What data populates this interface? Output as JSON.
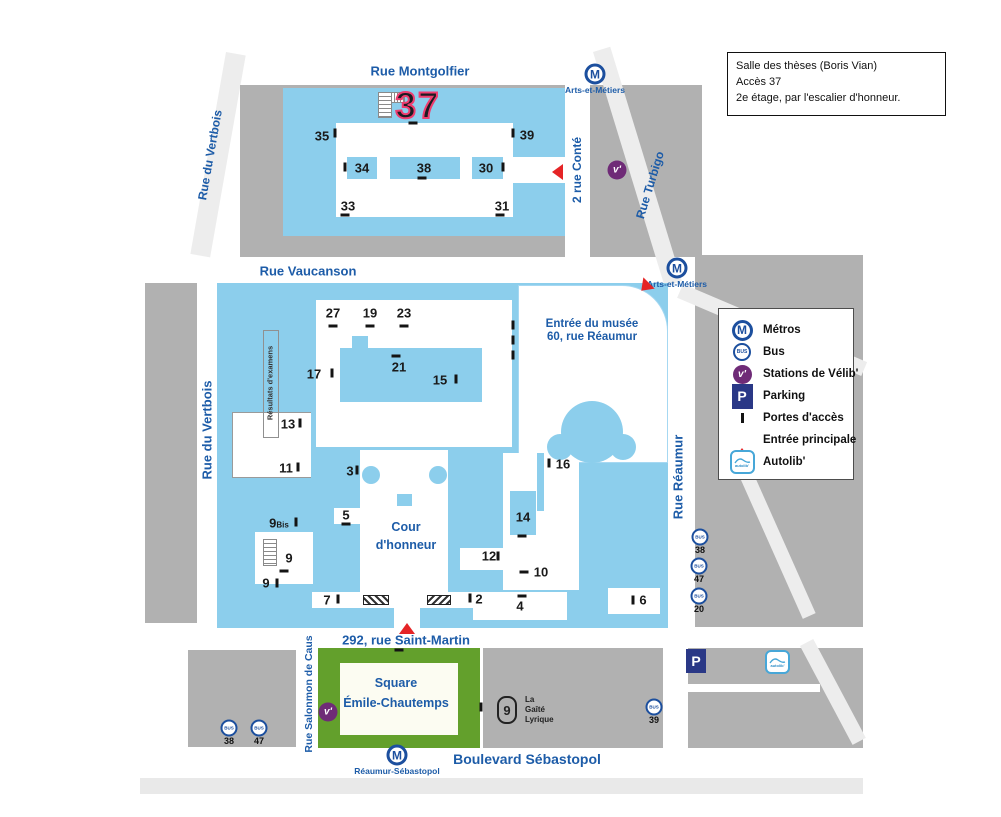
{
  "info_box": {
    "lines": [
      "Salle des thèses (Boris Vian)",
      "Accès 37",
      "2e étage, par l'escalier d'honneur."
    ]
  },
  "legend": {
    "items": [
      {
        "icon": "metro-icon",
        "label": "Métros"
      },
      {
        "icon": "bus-icon",
        "label": "Bus"
      },
      {
        "icon": "velib-icon",
        "label": "Stations de Vélib'"
      },
      {
        "icon": "parking-icon",
        "label": "Parking"
      },
      {
        "icon": "gate-icon",
        "label": "Portes  d'accès"
      },
      {
        "icon": "entrance-arrow-icon",
        "label": "Entrée  principale"
      },
      {
        "icon": "autolib-icon",
        "label": "Autolib'"
      }
    ]
  },
  "places": {
    "cour": [
      "Cour",
      "d'honneur"
    ],
    "musee": [
      "Entrée du musée",
      "60, rue Réaumur"
    ],
    "square": [
      "Square",
      "Émile-Chautemps"
    ],
    "gaite": [
      "La",
      "Gaîté",
      "Lyrique"
    ],
    "gaite_glyph": "9",
    "resultats": "Résultats d'examens"
  },
  "colors": {
    "building_blue": "#8CCEEC",
    "block_gray": "#B1B1B1",
    "street_gray": "#EDEDED",
    "text_blue": "#1D5CA8",
    "metro_blue": "#1C4F9E",
    "velib_purple": "#6F2B77",
    "parking_navy": "#2A3886",
    "arrow_red": "#E52426",
    "square_green": "#63A02C",
    "big_number_outline_pink": "#EE3D6F"
  },
  "map": {
    "streets": [
      {
        "label": "Rue Montgolfier",
        "x": 420,
        "y": 71,
        "size": 13
      },
      {
        "label": "Rue du Vertbois",
        "x": 210,
        "y": 155,
        "rot": -80,
        "size": 12
      },
      {
        "label": "2 rue Conté",
        "x": 577,
        "y": 170,
        "rot": -90,
        "size": 12
      },
      {
        "label": "Rue Turbigo",
        "x": 650,
        "y": 185,
        "rot": -73,
        "size": 12
      },
      {
        "label": "Rue Vaucanson",
        "x": 308,
        "y": 271,
        "size": 13
      },
      {
        "label": "Rue du Vertbois",
        "x": 207,
        "y": 430,
        "rot": -90,
        "size": 13
      },
      {
        "label": "Rue Réaumur",
        "x": 678,
        "y": 477,
        "rot": -90,
        "size": 13
      },
      {
        "label": "292, rue Saint-Martin",
        "x": 406,
        "y": 640,
        "size": 13
      },
      {
        "label": "Rue Salonmon de Caus",
        "x": 309,
        "y": 694,
        "rot": -90,
        "size": 10.5
      },
      {
        "label": "Boulevard Sébastopol",
        "x": 527,
        "y": 759,
        "size": 14
      }
    ],
    "metros": [
      {
        "label": "Arts-et-Métiers",
        "cx": 595,
        "cy": 74,
        "lx": 595,
        "ly": 90
      },
      {
        "label": "Arts-et-Métiers",
        "cx": 677,
        "cy": 268,
        "lx": 677,
        "ly": 284
      },
      {
        "label": "Réaumur-Sébastopol",
        "cx": 397,
        "cy": 755,
        "lx": 397,
        "ly": 771
      }
    ],
    "velib": [
      {
        "x": 617,
        "y": 170
      },
      {
        "x": 328,
        "y": 712
      }
    ],
    "bus_stops": [
      {
        "n": "38",
        "x": 700,
        "y": 537
      },
      {
        "n": "47",
        "x": 699,
        "y": 566
      },
      {
        "n": "20",
        "x": 699,
        "y": 596
      },
      {
        "n": "38",
        "x": 229,
        "y": 728
      },
      {
        "n": "47",
        "x": 259,
        "y": 728
      },
      {
        "n": "39",
        "x": 654,
        "y": 707
      }
    ],
    "parking": [
      {
        "x": 686,
        "y": 649
      }
    ],
    "autolib": [
      {
        "x": 765,
        "y": 650
      }
    ],
    "arrows": [
      {
        "x": 538,
        "y": 161,
        "rot": -90
      },
      {
        "x": 629,
        "y": 284,
        "rot": -135
      },
      {
        "x": 399,
        "y": 606,
        "rot": 0
      }
    ],
    "numbers": [
      {
        "l": "37",
        "x": 418,
        "y": 106,
        "big": 1
      },
      {
        "l": "35",
        "x": 322,
        "y": 136
      },
      {
        "l": "39",
        "x": 527,
        "y": 135
      },
      {
        "l": "34",
        "x": 362,
        "y": 168
      },
      {
        "l": "38",
        "x": 424,
        "y": 168
      },
      {
        "l": "30",
        "x": 486,
        "y": 168
      },
      {
        "l": "33",
        "x": 348,
        "y": 206
      },
      {
        "l": "31",
        "x": 502,
        "y": 206
      },
      {
        "l": "27",
        "x": 333,
        "y": 313
      },
      {
        "l": "19",
        "x": 370,
        "y": 313
      },
      {
        "l": "23",
        "x": 404,
        "y": 313
      },
      {
        "l": "17",
        "x": 314,
        "y": 374
      },
      {
        "l": "21",
        "x": 399,
        "y": 367
      },
      {
        "l": "15",
        "x": 440,
        "y": 380
      },
      {
        "l": "13",
        "x": 288,
        "y": 424
      },
      {
        "l": "11",
        "x": 286,
        "y": 468
      },
      {
        "l": "9",
        "sub": "Bis",
        "x": 279,
        "y": 523
      },
      {
        "l": "9",
        "x": 289,
        "y": 558
      },
      {
        "l": "9",
        "x": 266,
        "y": 583
      },
      {
        "l": "3",
        "x": 350,
        "y": 471
      },
      {
        "l": "5",
        "x": 346,
        "y": 515
      },
      {
        "l": "16",
        "x": 563,
        "y": 464
      },
      {
        "l": "14",
        "x": 523,
        "y": 517
      },
      {
        "l": "12",
        "x": 489,
        "y": 556
      },
      {
        "l": "10",
        "x": 541,
        "y": 572
      },
      {
        "l": "7",
        "x": 327,
        "y": 600
      },
      {
        "l": "2",
        "x": 479,
        "y": 599
      },
      {
        "l": "4",
        "x": 520,
        "y": 606
      },
      {
        "l": "6",
        "x": 643,
        "y": 600
      }
    ],
    "ticks": [
      {
        "x": 335,
        "y": 133,
        "o": "v"
      },
      {
        "x": 513,
        "y": 133,
        "o": "v"
      },
      {
        "x": 413,
        "y": 123,
        "o": "h"
      },
      {
        "x": 345,
        "y": 167,
        "o": "v"
      },
      {
        "x": 422,
        "y": 178,
        "o": "h"
      },
      {
        "x": 503,
        "y": 167,
        "o": "v"
      },
      {
        "x": 345,
        "y": 215,
        "o": "h"
      },
      {
        "x": 500,
        "y": 215,
        "o": "h"
      },
      {
        "x": 333,
        "y": 326,
        "o": "h"
      },
      {
        "x": 370,
        "y": 326,
        "o": "h"
      },
      {
        "x": 404,
        "y": 326,
        "o": "h"
      },
      {
        "x": 396,
        "y": 356,
        "o": "h"
      },
      {
        "x": 332,
        "y": 373,
        "o": "v"
      },
      {
        "x": 456,
        "y": 379,
        "o": "v"
      },
      {
        "x": 300,
        "y": 423,
        "o": "v"
      },
      {
        "x": 298,
        "y": 467,
        "o": "v"
      },
      {
        "x": 296,
        "y": 522,
        "o": "v"
      },
      {
        "x": 284,
        "y": 571,
        "o": "h"
      },
      {
        "x": 277,
        "y": 583,
        "o": "v"
      },
      {
        "x": 357,
        "y": 470,
        "o": "v"
      },
      {
        "x": 346,
        "y": 524,
        "o": "h"
      },
      {
        "x": 338,
        "y": 599,
        "o": "v"
      },
      {
        "x": 470,
        "y": 598,
        "o": "v"
      },
      {
        "x": 522,
        "y": 596,
        "o": "h"
      },
      {
        "x": 524,
        "y": 572,
        "o": "h"
      },
      {
        "x": 522,
        "y": 536,
        "o": "h"
      },
      {
        "x": 549,
        "y": 463,
        "o": "v"
      },
      {
        "x": 498,
        "y": 556,
        "o": "v"
      },
      {
        "x": 633,
        "y": 600,
        "o": "v"
      },
      {
        "x": 513,
        "y": 325,
        "o": "v"
      },
      {
        "x": 513,
        "y": 340,
        "o": "v"
      },
      {
        "x": 513,
        "y": 355,
        "o": "v"
      },
      {
        "x": 481,
        "y": 707,
        "o": "v"
      },
      {
        "x": 399,
        "y": 650,
        "o": "h"
      }
    ],
    "stairs": [
      {
        "x": 378,
        "y": 92,
        "w": 14,
        "h": 26,
        "cap": 1
      },
      {
        "x": 263,
        "y": 539,
        "w": 14,
        "h": 27
      }
    ],
    "hatches": [
      {
        "x": 363,
        "y": 595,
        "w": 26,
        "h": 10,
        "d": 45
      },
      {
        "x": 427,
        "y": 595,
        "w": 24,
        "h": 10,
        "d": 135
      }
    ]
  }
}
